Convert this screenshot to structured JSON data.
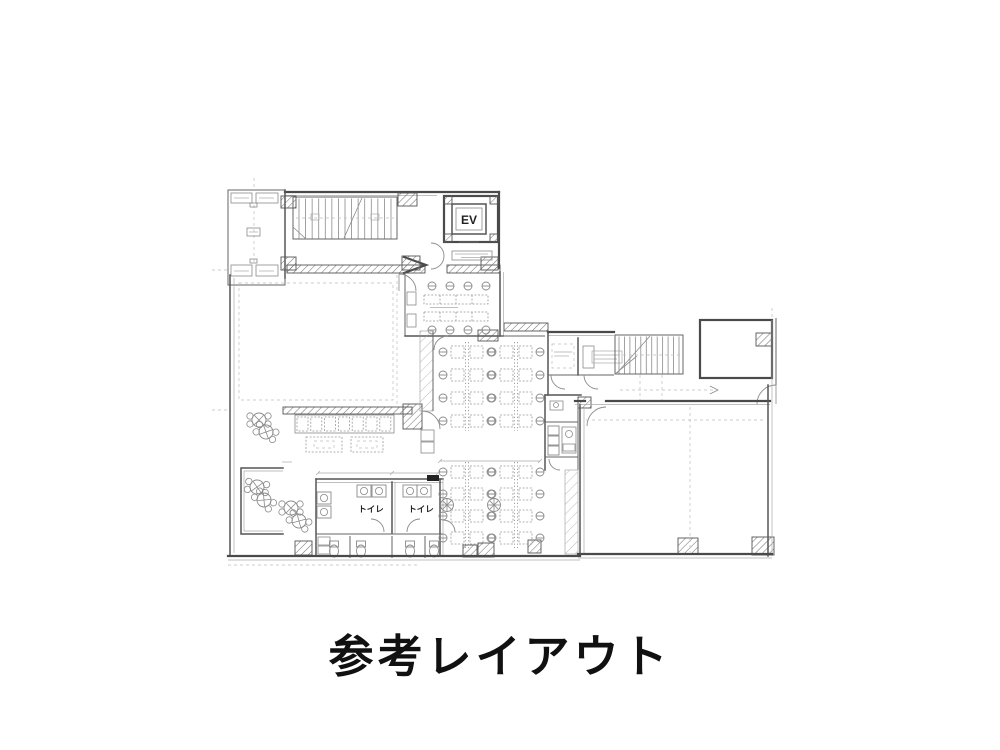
{
  "page": {
    "background": "#ffffff"
  },
  "caption": {
    "text": "参考レイアウト"
  },
  "plan": {
    "labels": {
      "elevator": "EV",
      "toilet_left": "トイレ",
      "toilet_right": "トイレ"
    },
    "colors": {
      "line": "#4a4a4a",
      "furniture": "#8a8a8a",
      "hatch": "#777777",
      "caption": "#111111"
    }
  }
}
